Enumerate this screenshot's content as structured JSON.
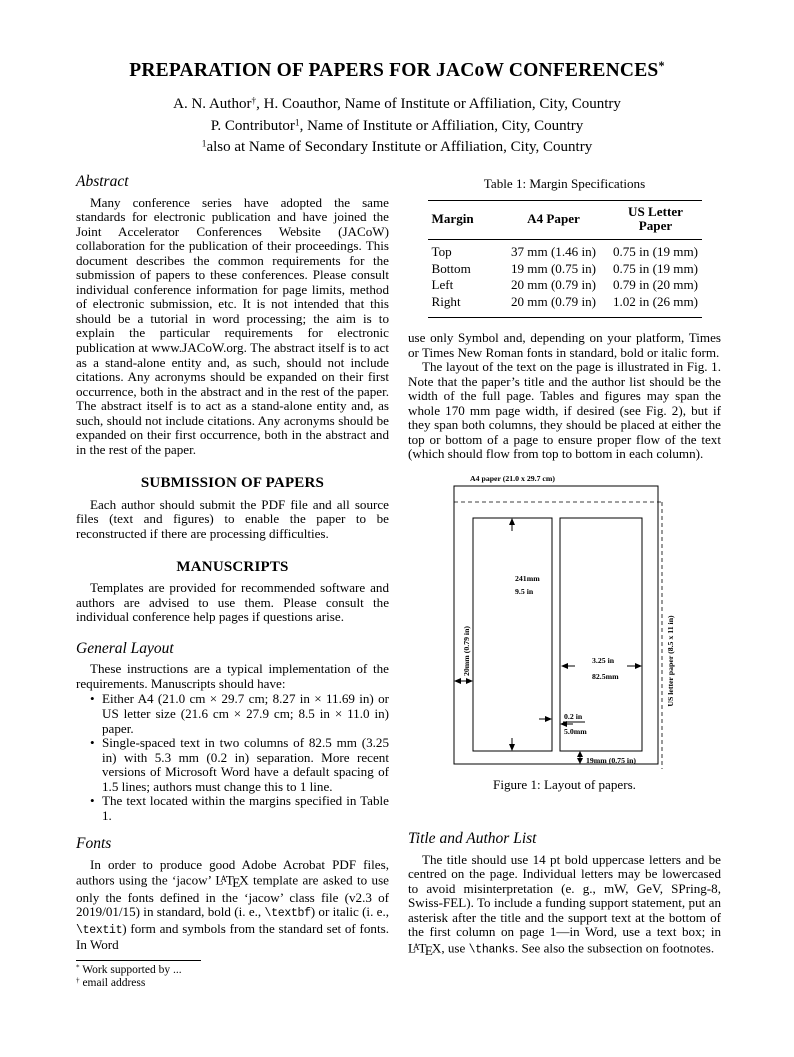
{
  "header": {
    "title_segs": [
      {
        "t": "PREPARATION OF PAPERS FOR JACoW CONFERENCES"
      },
      {
        "t": "*",
        "c": "sup"
      }
    ],
    "author_line1": [
      {
        "t": "A. N. Author"
      },
      {
        "t": "†",
        "c": "sup"
      },
      {
        "t": ", H. Coauthor, Name of Institute or Affiliation, City, Country"
      }
    ],
    "author_line2": [
      {
        "t": "P. Contributor"
      },
      {
        "t": "1",
        "c": "sup"
      },
      {
        "t": ", Name of Institute or Affiliation, City, Country"
      }
    ],
    "author_line3": [
      {
        "t": "1",
        "c": "sup"
      },
      {
        "t": "also at Name of Secondary Institute or Affiliation, City, Country"
      }
    ]
  },
  "left": {
    "abstract_heading": "Abstract",
    "abstract_text": "Many conference series have adopted the same standards for electronic publication and have joined the Joint Accelerator Conferences Website (JACoW) collaboration for the publication of their proceedings. This document describes the common requirements for the submission of papers to these conferences. Please consult individual conference information for page limits, method of electronic submission, etc. It is not intended that this should be a tutorial in word processing; the aim is to explain the particular requirements for electronic publication at www.JACoW.org. The abstract itself is to act as a stand-alone entity and, as such, should not include citations. Any acronyms should be expanded on their first occurrence, both in the abstract and in the rest of the paper. The abstract itself is to act as a stand-alone entity and, as such, should not include citations. Any acronyms should be expanded on their first occurrence, both in the abstract and in the rest of the paper.",
    "submission_heading": "SUBMISSION OF PAPERS",
    "submission_text": "Each author should submit the PDF file and all source files (text and figures) to enable the paper to be reconstructed if there are processing difficulties.",
    "manuscripts_heading": "MANUSCRIPTS",
    "manuscripts_text": "Templates are provided for recommended software and authors are advised to use them. Please consult the individual conference help pages if questions arise.",
    "general_layout_heading": "General Layout",
    "general_layout_intro": "These instructions are a typical implementation of the requirements. Manuscripts should have:",
    "bullet1": "Either A4 (21.0 cm × 29.7 cm; 8.27 in × 11.69 in) or US letter size (21.6 cm × 27.9 cm; 8.5 in × 11.0 in) paper.",
    "bullet2": "Single-spaced text in two columns of 82.5 mm (3.25 in) with 5.3 mm (0.2 in) separation. More recent versions of Microsoft Word have a default spacing of 1.5 lines; authors must change this to 1 line.",
    "bullet3": "The text located within the margins specified in Table 1.",
    "fonts_heading": "Fonts",
    "fonts_para_segs": [
      {
        "t": "In order to produce good Adobe Acrobat PDF files, authors using the ‘jacow’ "
      },
      {
        "t": "L"
      },
      {
        "t": "A",
        "c": "lxA"
      },
      {
        "t": "T"
      },
      {
        "t": "E",
        "c": "lxE"
      },
      {
        "t": "X"
      },
      {
        "t": " template are asked to use only the fonts defined in the ‘jacow’ class file (v2.3 of 2019/01/15) in standard, bold (i. e., "
      },
      {
        "t": "\\textbf",
        "c": "tt"
      },
      {
        "t": ") or italic (i. e., "
      },
      {
        "t": "\\textit",
        "c": "tt"
      },
      {
        "t": ") form and symbols from the standard set of fonts. In Word"
      }
    ],
    "footnote1": [
      {
        "t": "*",
        "c": "sup"
      },
      {
        "t": " Work supported by ..."
      }
    ],
    "footnote2": [
      {
        "t": "†",
        "c": "sup"
      },
      {
        "t": " email address"
      }
    ]
  },
  "right": {
    "table": {
      "caption": "Table 1: Margin Specifications",
      "headers": [
        "Margin",
        "A4 Paper",
        "US Letter Paper"
      ],
      "rows": [
        [
          "Top",
          "37 mm (1.46 in)",
          "0.75 in (19 mm)"
        ],
        [
          "Bottom",
          "19 mm (0.75 in)",
          "0.75 in (19 mm)"
        ],
        [
          "Left",
          "20 mm (0.79 in)",
          "0.79 in (20 mm)"
        ],
        [
          "Right",
          "20 mm (0.79 in)",
          "1.02 in (26 mm)"
        ]
      ]
    },
    "para1": "use only Symbol and, depending on your platform, Times or Times New Roman fonts in standard, bold or italic form.",
    "para2": "The layout of the text on the page is illustrated in Fig. 1. Note that the paper’s title and the author list should be the width of the full page. Tables and figures may span the whole 170 mm page width, if desired (see Fig. 2), but if they span both columns, they should be placed at either the top or bottom of a page to ensure proper flow of the text (which should flow from top to bottom in each column).",
    "figure": {
      "a4_label": "A4 paper (21.0 x 29.7 cm)",
      "us_letter_label": "US letter paper (8.5 x 11 in)",
      "col_height_mm": "241mm",
      "col_height_in": "9.5 in",
      "left_margin": "20mm (0.79 in)",
      "col_width_in": "3.25 in",
      "col_width_mm": "82.5mm",
      "gutter_in": "0.2 in",
      "gutter_mm": "5.0mm",
      "bottom_margin": "19mm (0.75 in)",
      "caption": "Figure 1: Layout of papers."
    },
    "title_author_heading": "Title and Author List",
    "title_author_segs": [
      {
        "t": "The title should use 14 pt bold uppercase letters and be centred on the page. Individual letters may be lowercased to avoid misinterpretation (e. g., mW, GeV, SPring-8, Swiss-FEL). To include a funding support statement, put an asterisk after the title and the support text at the bottom of the first column on page 1—in Word, use a text box; in "
      },
      {
        "t": "L"
      },
      {
        "t": "A",
        "c": "lxA"
      },
      {
        "t": "T"
      },
      {
        "t": "E",
        "c": "lxE"
      },
      {
        "t": "X"
      },
      {
        "t": ", use "
      },
      {
        "t": "\\thanks",
        "c": "tt"
      },
      {
        "t": ". See also the subsection on footnotes."
      }
    ]
  }
}
